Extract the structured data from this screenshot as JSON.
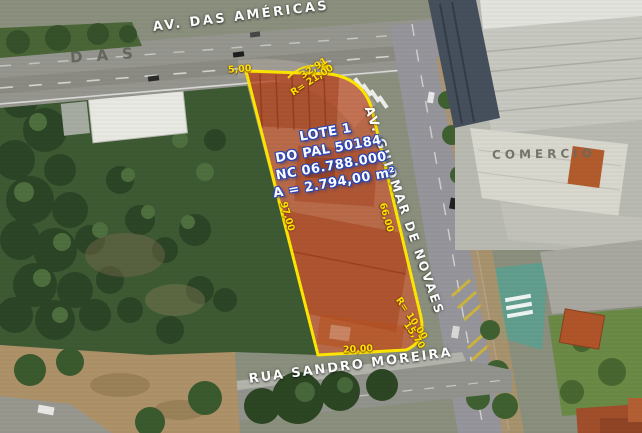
{
  "roads": {
    "americas": "AV. DAS AMÉRICAS",
    "guiomar": "AV. GUIOMAR DE NOVAES",
    "sandro": "RUA SANDRO MOREIRA",
    "faint_das": "DAS",
    "faint_comercio": "COMERCIO"
  },
  "lot": {
    "info_lines": [
      "LOTE 1",
      "DO PAL 50184",
      "NC 06.788.000",
      "A = 2.794,00 m²"
    ],
    "dimensions": {
      "top_left": "5,00",
      "arc_top_length": "32,91",
      "arc_top_radius": "R= 21,00",
      "left_side": "97,00",
      "right_side": "66,00",
      "arc_bottom_radius": "R= 10,00",
      "arc_bottom_length": "15,70",
      "bottom": "20,00"
    },
    "colors": {
      "outline": "#FFE600",
      "fill": "#E04E1E",
      "info_text": "#FFFFFF",
      "info_outline": "#2946B8",
      "dimension_text": "#FFE600"
    }
  }
}
